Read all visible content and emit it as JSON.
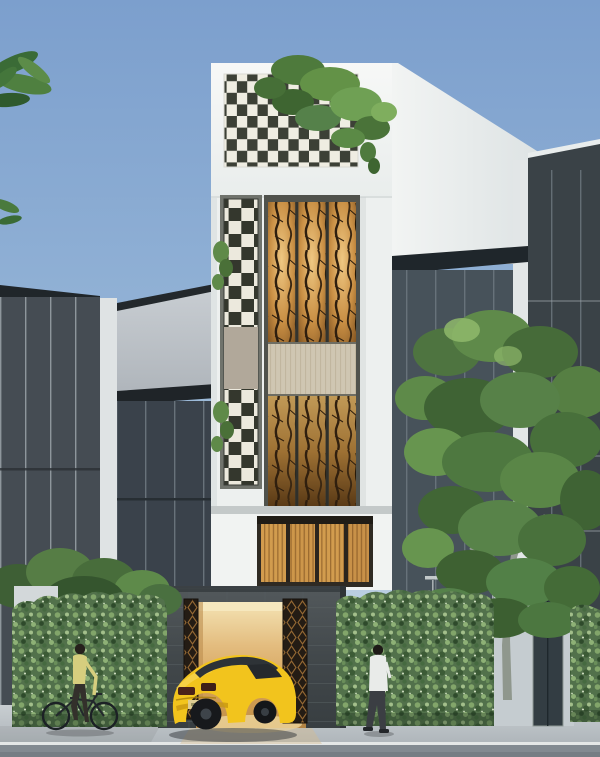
{
  "image": {
    "kind": "architectural-exterior-rendering",
    "width_px": 600,
    "height_px": 757
  },
  "scene": {
    "objects": [
      "blue-sky",
      "top-left-palm-leaves",
      "left-glass-building",
      "left-concrete-building",
      "main-townhouse",
      "checkered-brick-screen",
      "rooftop-plants",
      "checkered-side-strip",
      "upper-amber-lattice-window",
      "slat-spandrel-band",
      "lower-amber-lattice-window",
      "first-floor-amber-window",
      "stone-garage",
      "patterned-gate-left",
      "patterned-gate-right",
      "yellow-sports-car",
      "left-ivy-hedge",
      "right-ivy-hedge",
      "far-right-hedge",
      "left-bushes",
      "street-tree",
      "right-glass-tower",
      "right-mid-building",
      "entrance-door",
      "cyclist-with-bicycle",
      "pedestrian",
      "sidewalk",
      "curb",
      "street"
    ]
  },
  "colors": {
    "sky_top": "#7C9FCD",
    "sky_horizon": "#CBD9E6",
    "facade_white": "#F2F4F3",
    "checker_light": "#EFEDE2",
    "checker_dark": "#3C4036",
    "window_frame": "#50524C",
    "amber_light": "#EFC883",
    "amber_mid": "#C98F44",
    "amber_deep": "#6F4519",
    "spandrel_beige": "#CFC6B2",
    "stone_dark": "#42484B",
    "garage_glow": "#E9C583",
    "gate_dark": "#241C14",
    "gate_amber": "#B9813D",
    "car_yellow": "#F2C41D",
    "hedge_green": "#52714B",
    "tree_green": "#4E7840",
    "glass_dark": "#454C53",
    "roof_dark": "#20262A",
    "pillar_white": "#DFE3E4",
    "street_gray": "#828A91",
    "sidewalk_gray": "#C2C8CC",
    "trunk_gray": "#8F978D",
    "shirt_yellow": "#D6CE7E",
    "shirt_white": "#E9EBE9"
  }
}
